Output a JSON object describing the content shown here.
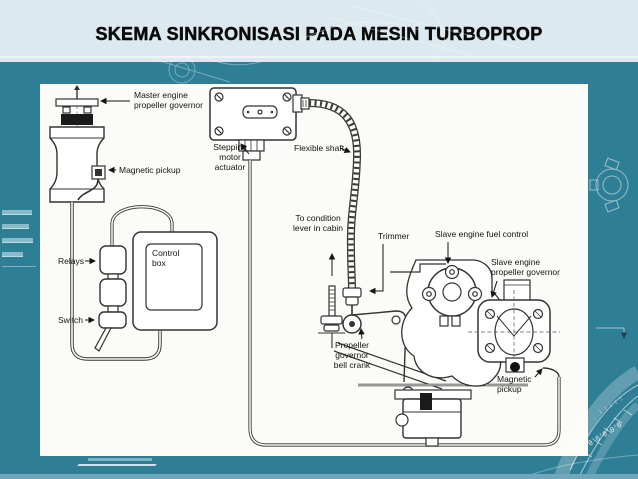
{
  "slide": {
    "title": "SKEMA SINKRONISASI PADA MESIN TURBOPROP"
  },
  "colors": {
    "background_teal": "#2e7e96",
    "header_band": "#dce9ee",
    "panel_white": "#fbfbf8",
    "line_art": "#333333",
    "footer_strip": "#72a7bb"
  },
  "diagram": {
    "labels": {
      "master_governor": [
        "Master engine",
        "propeller governor"
      ],
      "magnetic_pickup_master": [
        "Magnetic pickup"
      ],
      "stepping_motor": [
        "Stepping",
        "motor",
        "actuator"
      ],
      "flexible_shaft": [
        "Flexible shaft"
      ],
      "condition_lever": [
        "To condition",
        "lever in cabin"
      ],
      "trimmer": [
        "Trimmer"
      ],
      "fuel_control": [
        "Slave engine fuel control"
      ],
      "slave_governor": [
        "Slave engine",
        "propeller governor"
      ],
      "bell_crank": [
        "Propeller",
        "governor",
        "bell crank"
      ],
      "magnetic_pickup_slave": [
        "Magnetic",
        "pickup"
      ],
      "control_box": [
        "Control",
        "box"
      ],
      "relays": [
        "Relays"
      ],
      "switch": [
        "Switch"
      ]
    }
  }
}
